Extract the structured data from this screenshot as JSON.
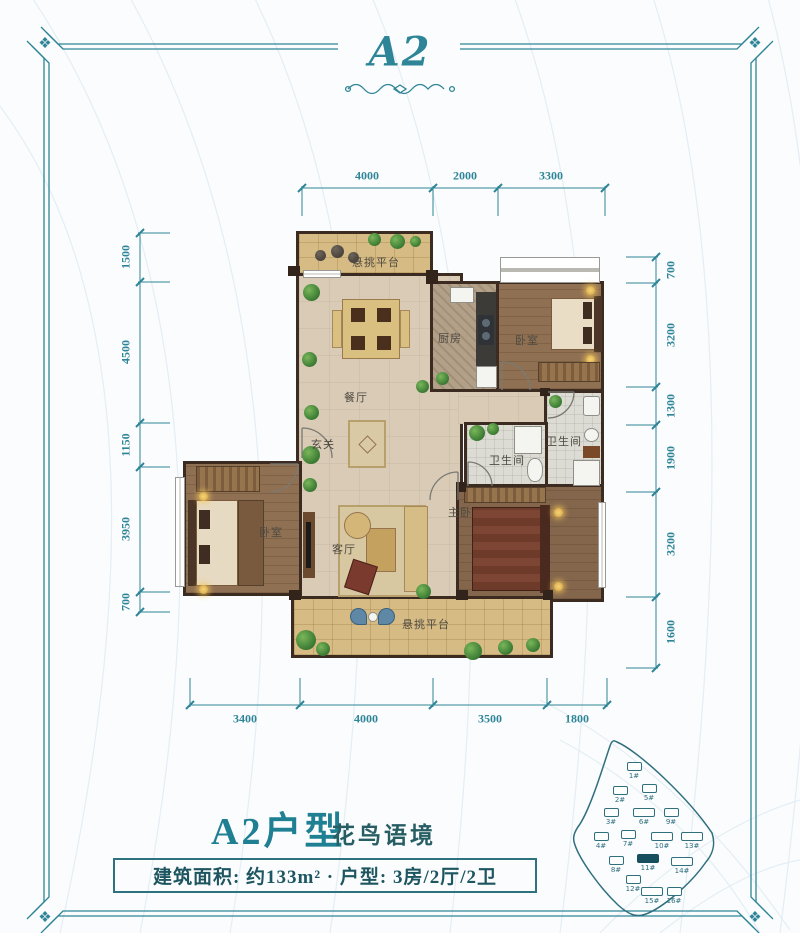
{
  "logo": {
    "text": "A2"
  },
  "frame": {
    "corner_ornament": "❖"
  },
  "title": {
    "main": "A2户型",
    "sub": "花鸟语境"
  },
  "info_bar": {
    "text": "建筑面积: 约133m² · 户型: 3房/2厅/2卫"
  },
  "dimensions": {
    "top": [
      "4000",
      "2000",
      "3300"
    ],
    "bottom": [
      "3400",
      "4000",
      "3500",
      "1800"
    ],
    "left": [
      "1500",
      "4500",
      "1150",
      "3950",
      "700"
    ],
    "right": [
      "700",
      "3200",
      "1300",
      "1900",
      "3200",
      "1600"
    ]
  },
  "rooms": {
    "balcony_top": "悬挑平台",
    "kitchen": "厨房",
    "bedroom_top_right": "卧室",
    "dining": "餐厅",
    "foyer": "玄关",
    "bath_ensuite": "卫生间",
    "bath_common": "卫生间",
    "master_bedroom": "主卧",
    "living_room": "客厅",
    "bedroom_left": "卧室",
    "balcony_bottom": "悬挑平台"
  },
  "siteplan": {
    "buildings": [
      {
        "label": "1#",
        "highlight": false
      },
      {
        "label": "2#",
        "highlight": false
      },
      {
        "label": "3#",
        "highlight": false
      },
      {
        "label": "4#",
        "highlight": false
      },
      {
        "label": "5#",
        "highlight": false
      },
      {
        "label": "6#",
        "highlight": false
      },
      {
        "label": "7#",
        "highlight": false
      },
      {
        "label": "8#",
        "highlight": false
      },
      {
        "label": "9#",
        "highlight": false
      },
      {
        "label": "10#",
        "highlight": false
      },
      {
        "label": "11#",
        "highlight": true
      },
      {
        "label": "12#",
        "highlight": false
      },
      {
        "label": "13#",
        "highlight": false
      },
      {
        "label": "14#",
        "highlight": false
      },
      {
        "label": "15#",
        "highlight": false
      },
      {
        "label": "16#",
        "highlight": false
      }
    ]
  },
  "colors": {
    "accent": "#2e8597",
    "title_teal": "#1f7f93",
    "ink_dark": "#1d5560",
    "wall_brown": "#3b2b20",
    "siteplan_teal": "#2f6f7e"
  }
}
